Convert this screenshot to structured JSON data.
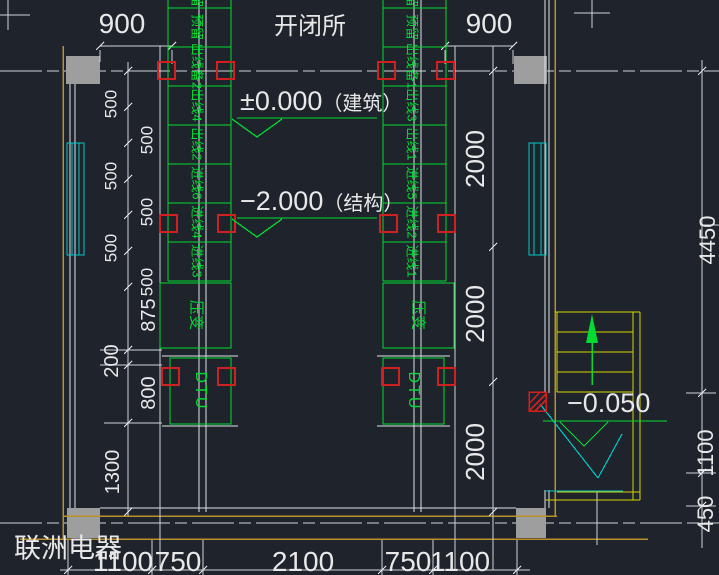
{
  "title": "开闭所",
  "company": "联洲电器",
  "elevations": {
    "building_value": "±0.000",
    "building_label": "（建筑）",
    "structure_value": "−2.000",
    "structure_label": "（结构）",
    "stair_value": "−0.050"
  },
  "dimensions": {
    "top": [
      "900",
      "900"
    ],
    "bottom": [
      "1100",
      "750",
      "2100",
      "750",
      "1100"
    ],
    "left_chain": [
      "500",
      "500",
      "500",
      "500",
      "500",
      "500",
      "875",
      "200",
      "800",
      "1300"
    ],
    "right_chain": [
      "2000",
      "2000",
      "2000"
    ],
    "far_right_chain": [
      "4450",
      "1100",
      "450"
    ]
  },
  "panels": {
    "left_column": {
      "cells": [
        "预留",
        "预留",
        "出线备2",
        "出线4",
        "出线2",
        "进线6",
        "进线4",
        "进线3"
      ],
      "pt_box": "压变",
      "dtu_box": "DTU"
    },
    "right_column": {
      "cells": [
        "预留",
        "预留",
        "出线备1",
        "出线3",
        "出线1",
        "进线5",
        "进线2",
        "进线1"
      ],
      "pt_box": "压变",
      "dtu_box": "DTU"
    }
  },
  "colors": {
    "background": "#1f232c",
    "line_white": "#e8e8e8",
    "wall_yellow": "#b9902c",
    "stair_yellow": "#d6d600",
    "equipment_green": "#00dc32",
    "window_cyan": "#00c8c8",
    "marker_red": "#d02020",
    "column_gray": "#9e9e9e"
  }
}
